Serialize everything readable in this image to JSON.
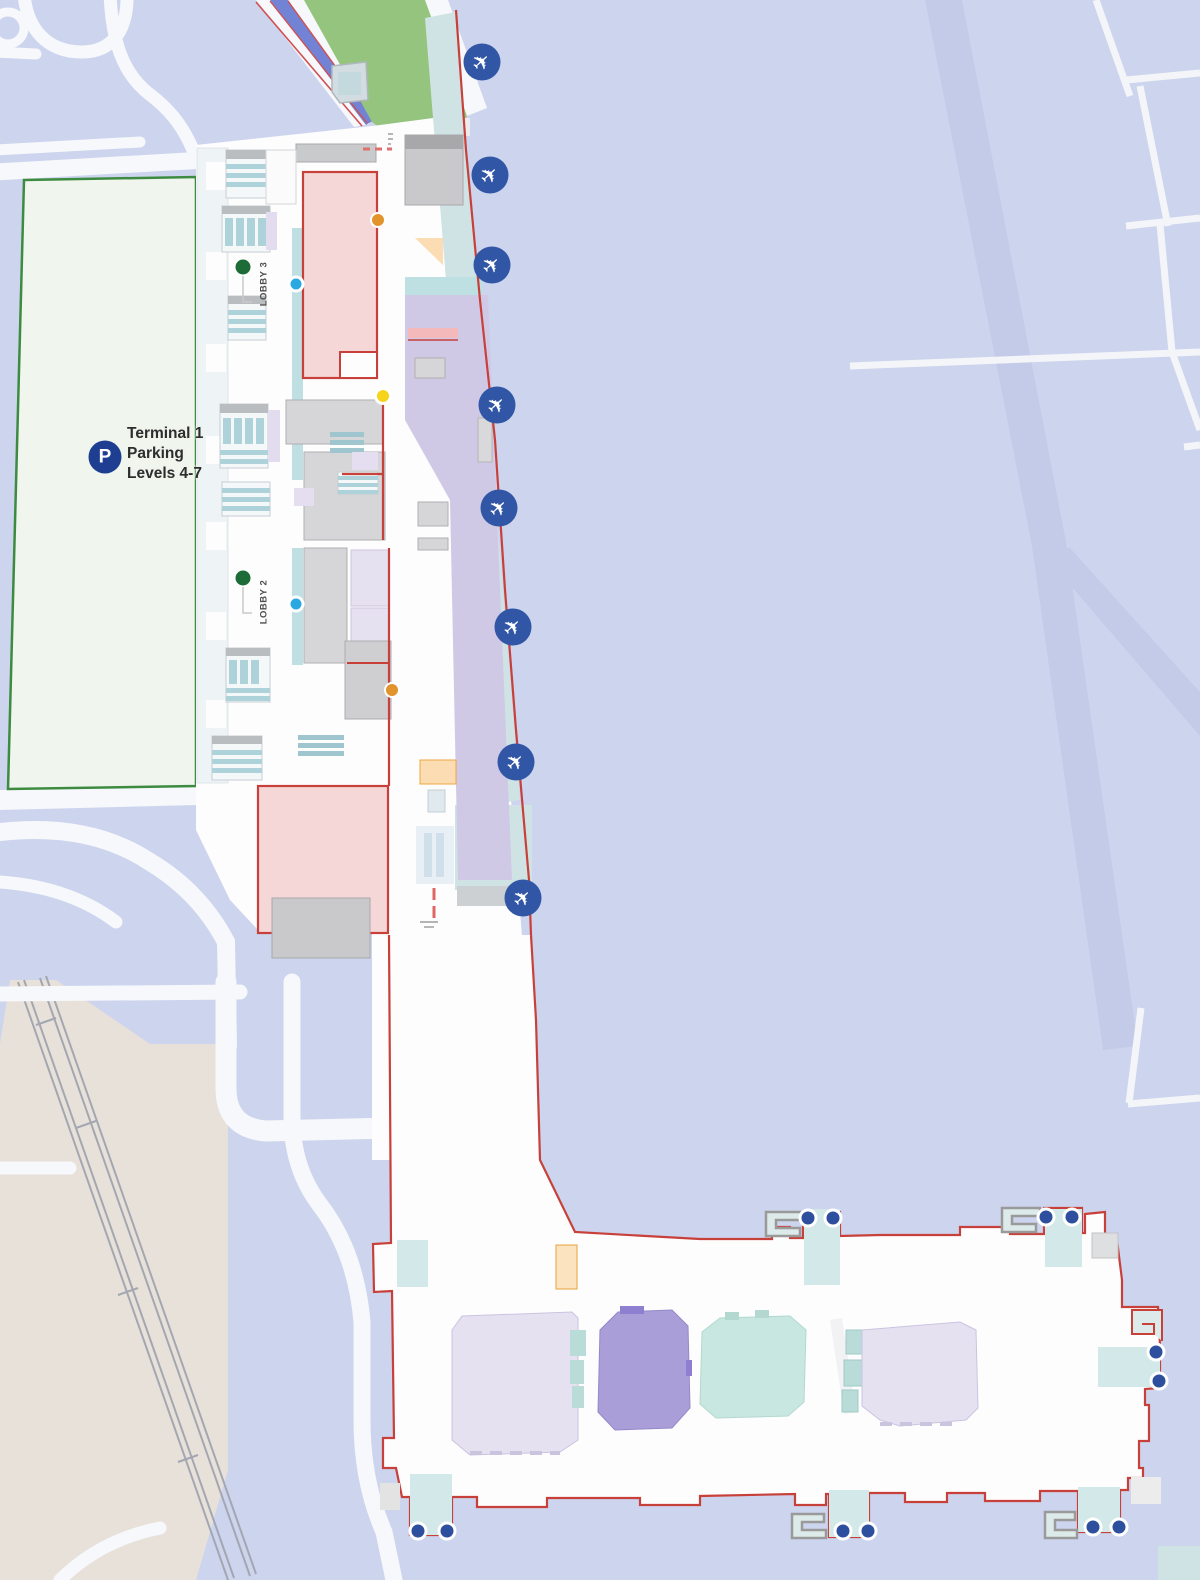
{
  "map_title": "Terminal 1 airport map",
  "labels": {
    "parking": {
      "line1": "Terminal 1",
      "line2": "Parking",
      "line3": "Levels 4-7",
      "icon": "parking-icon",
      "icon_letter": "P",
      "x": 105,
      "y": 457
    },
    "lobbies": [
      {
        "text": "LOBBY 3",
        "x": 264,
        "y": 284
      },
      {
        "text": "LOBBY 2",
        "x": 264,
        "y": 602
      }
    ]
  },
  "markers": {
    "plane_glyph": "✈",
    "planes": [
      {
        "x": 482,
        "y": 62
      },
      {
        "x": 490,
        "y": 175
      },
      {
        "x": 492,
        "y": 265
      },
      {
        "x": 497,
        "y": 405
      },
      {
        "x": 499,
        "y": 508
      },
      {
        "x": 513,
        "y": 627
      },
      {
        "x": 516,
        "y": 762
      },
      {
        "x": 523,
        "y": 898
      }
    ],
    "gates": [
      {
        "x": 808,
        "y": 1218
      },
      {
        "x": 833,
        "y": 1218
      },
      {
        "x": 1046,
        "y": 1217
      },
      {
        "x": 1072,
        "y": 1217
      },
      {
        "x": 1156,
        "y": 1352
      },
      {
        "x": 1159,
        "y": 1381
      },
      {
        "x": 418,
        "y": 1531
      },
      {
        "x": 447,
        "y": 1531
      },
      {
        "x": 843,
        "y": 1531
      },
      {
        "x": 868,
        "y": 1531
      },
      {
        "x": 1093,
        "y": 1527
      },
      {
        "x": 1119,
        "y": 1527
      }
    ],
    "lobby_entrances": [
      {
        "x": 296,
        "y": 284
      },
      {
        "x": 296,
        "y": 604
      }
    ],
    "info_green": [
      {
        "x": 243,
        "y": 267
      },
      {
        "x": 243,
        "y": 578
      }
    ],
    "info_orange": [
      {
        "x": 378,
        "y": 220
      },
      {
        "x": 392,
        "y": 690
      }
    ],
    "info_yellow": [
      {
        "x": 383,
        "y": 396
      }
    ]
  },
  "colors": {
    "background_apron": "#cdd4ee",
    "taxiway_stripe": "#c3cbe9",
    "road_white": "#f7f8fb",
    "ground_beige": "#e8e1da",
    "park_green": "#94c47e",
    "parking_fill": "#f0f5ed",
    "parking_border": "#3d8b41",
    "ramp_blue": "#7283d5",
    "terminal_white": "#fdfdfe",
    "secure_boundary_red": "#c8403a",
    "pre_security_pink": "#f5d7d8",
    "concourse_teal": "#cfe3e5",
    "interior_lavender": "#e6e1f1",
    "interior_purple": "#aa9ed8",
    "interior_mint": "#c9e7e1",
    "plane_marker_blue": "#3156a5",
    "gate_dot_blue": "#2d4f9e",
    "entrance_cyan": "#29a8e2",
    "info_green": "#1d6b37",
    "info_orange": "#e2932c",
    "info_yellow": "#f6d41c",
    "parking_icon_blue": "#1e3e92"
  }
}
